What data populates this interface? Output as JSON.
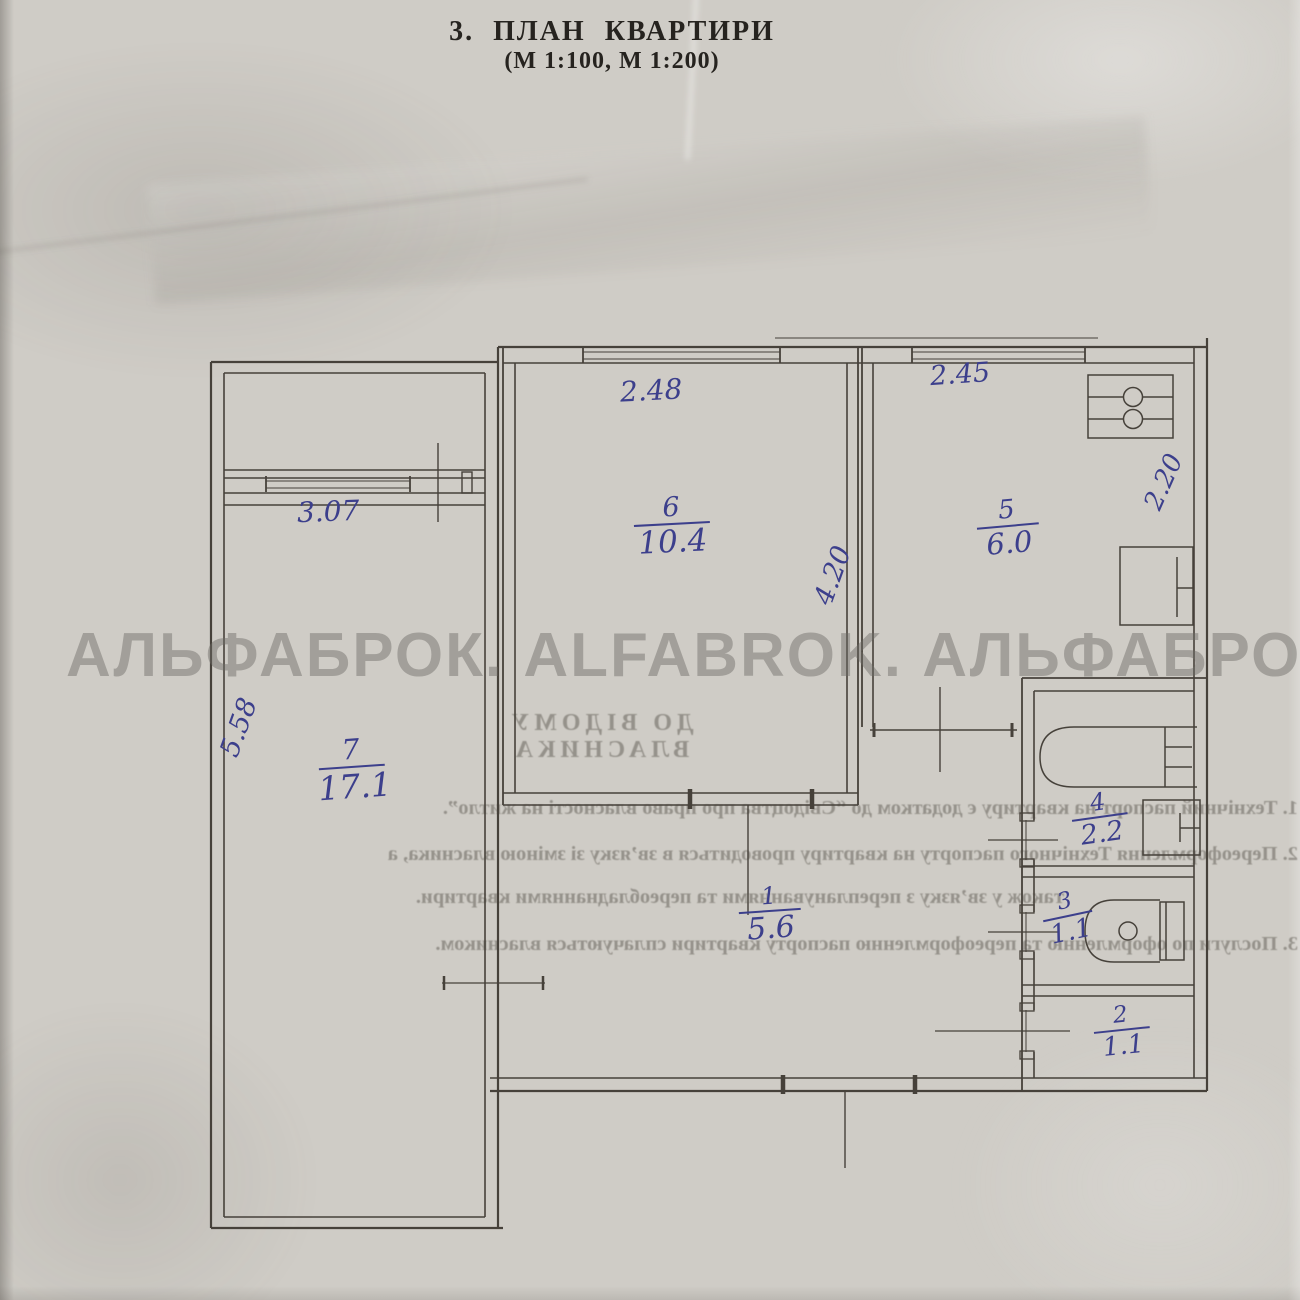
{
  "page": {
    "title_line1": "3.  ПЛАН  КВАРТИРИ",
    "title_line2": "(М 1:100, М 1:200)",
    "watermark": "АЛЬФАБРОК. ALFABROK. АЛЬФАБРОК"
  },
  "plan": {
    "rooms": {
      "r1": {
        "number": "1",
        "area": "5.6"
      },
      "r2": {
        "number": "2",
        "area": "1.1"
      },
      "r3": {
        "number": "3",
        "area": "1.1"
      },
      "r4": {
        "number": "4",
        "area": "2.2"
      },
      "r5": {
        "number": "5",
        "area": "6.0"
      },
      "r6": {
        "number": "6",
        "area": "10.4"
      },
      "r7": {
        "number": "7",
        "area": "17.1"
      }
    },
    "dimensions": {
      "d307": "3.07",
      "d248": "2.48",
      "d245": "2.45",
      "d558": "5.58",
      "d420": "4.20",
      "d220": "2.20"
    },
    "fixtures": [
      "stove-icon",
      "kitchen-sink-icon",
      "bathtub-icon",
      "washbasin-icon",
      "toilet-icon"
    ],
    "colors": {
      "ink": "#3c3f8c",
      "line": "#46413a",
      "paper": "#cfccc6"
    }
  },
  "bleed_text": {
    "heading": "ДО ВІДОМУ ВЛАСНИКА",
    "line1": "1. Технічний паспорт на квартиру є додатком до “Свідоцтва про право власності на житло”.",
    "line2": "2. Переоформлення Технічного паспорту на квартиру проводиться в зв’язку зі зміною власника, а",
    "line3": "також у зв’язку з переплануваннями та переобладнаннями квартири.",
    "line4": "3. Послуги по оформленню та переоформленню паспорту квартири сплачуються власником."
  }
}
